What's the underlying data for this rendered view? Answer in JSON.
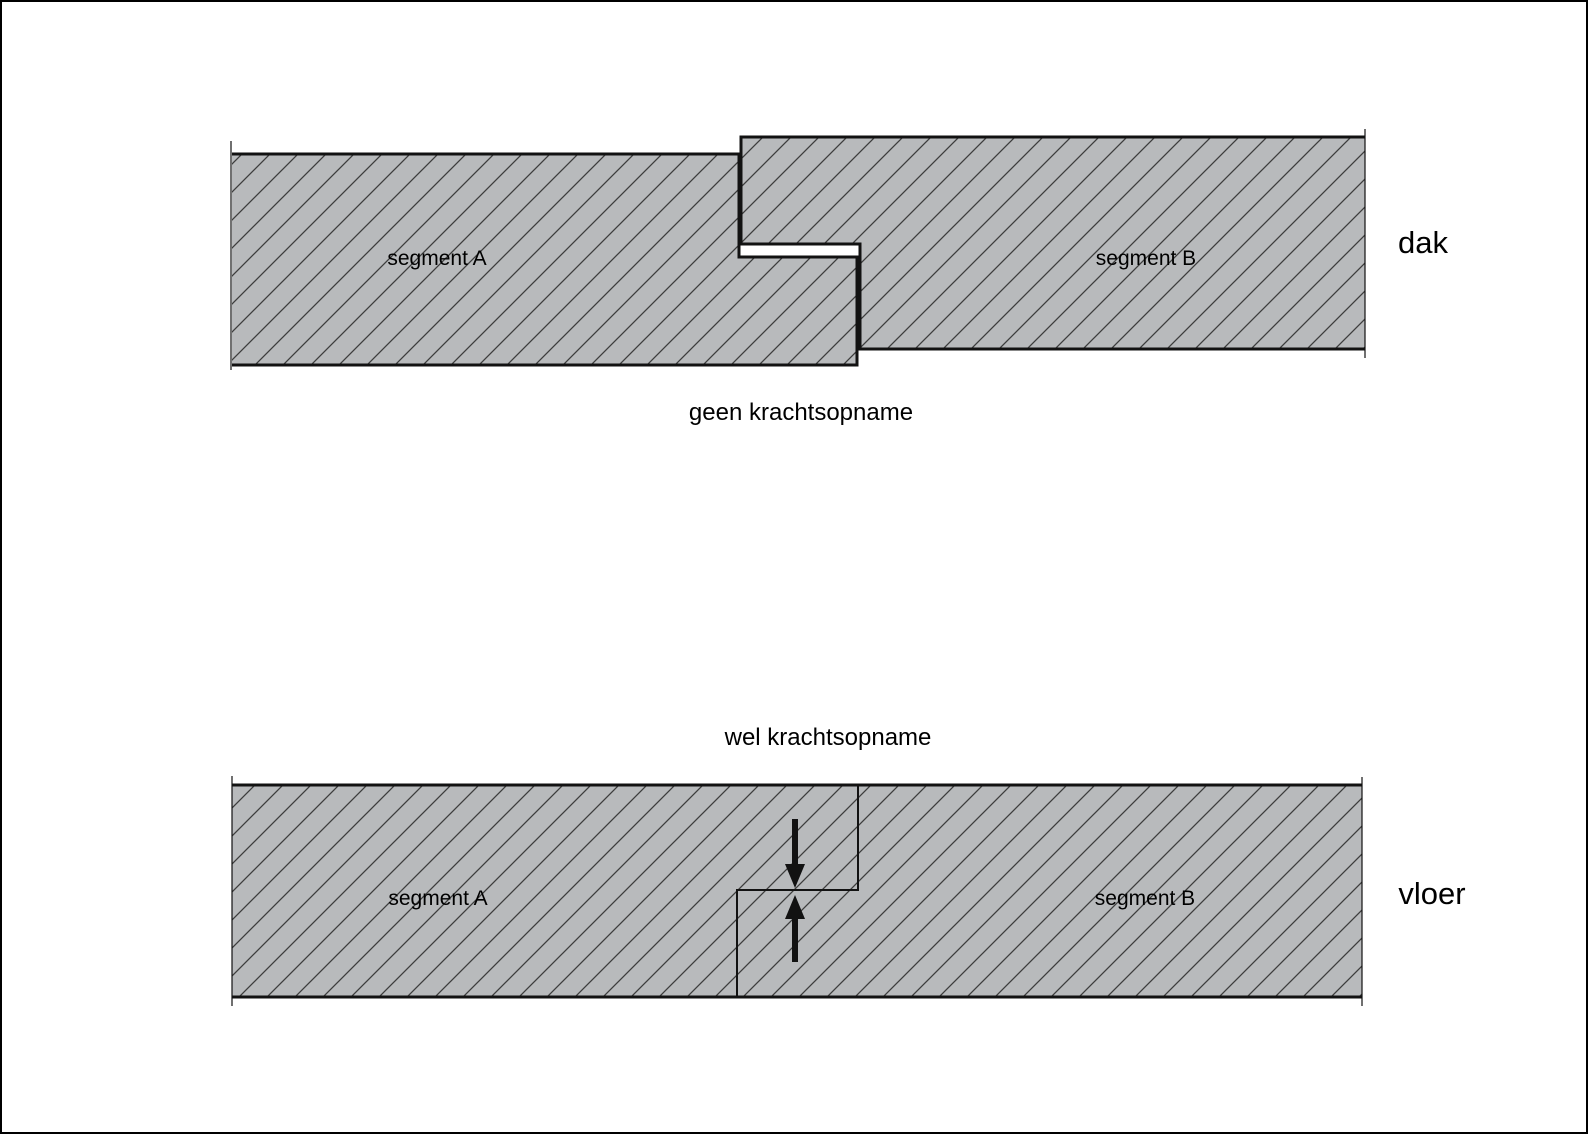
{
  "colors": {
    "background": "#ffffff",
    "canvas_border": "#000000",
    "segment_fill": "#b8babc",
    "hatch_line": "#3d3d3d",
    "outline": "#121212",
    "text": "#000000"
  },
  "roof": {
    "segment_a_label": "segment A",
    "segment_b_label": "segment B",
    "caption": "geen krachtsopname",
    "side_label": "dak"
  },
  "floor": {
    "segment_a_label": "segment A",
    "segment_b_label": "segment B",
    "caption": "wel krachtsopname",
    "side_label": "vloer"
  }
}
